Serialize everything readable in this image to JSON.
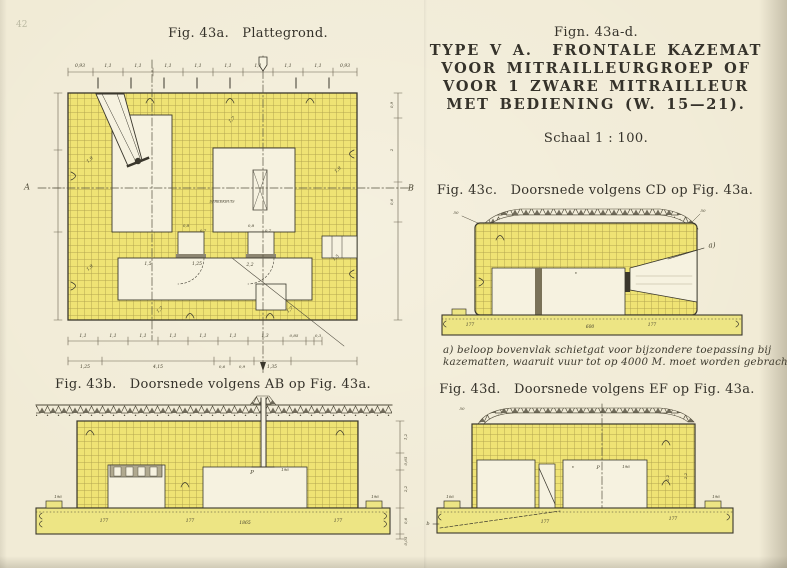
{
  "page": {
    "ghost_page_number": "42",
    "captions": {
      "fig43a": "Fig. 43a.   Plattegrond.",
      "fig43b": "Fig. 43b.   Doorsnede volgens AB op Fig. 43a.",
      "fig43c": "Fig. 43c.   Doorsnede volgens CD op Fig. 43a.",
      "fig43d": "Fig. 43d.   Doorsnede volgens EF op Fig. 43a."
    },
    "title_block": {
      "fign": "Fign. 43a-d.",
      "line1": "TYPE V A.  FRONTALE KAZEMAT",
      "line2": "VOOR MITRAILLEURGROEP OF",
      "line3": "VOOR 1 ZWARE MITRAILLEUR",
      "line4": "MET BEDIENING (W. 15—21).",
      "scale": "Schaal 1 : 100."
    },
    "note_a": {
      "line1": "a) beloop bovenvlak schietgat voor bijzondere toepassing bij",
      "line2": "kazematten, waaruit vuur tot op 4000 M. moet worden gebracht."
    }
  },
  "colors": {
    "paper": "#f1ebd6",
    "wall": "#efe374",
    "slab": "#ede584",
    "room": "#f6f2e0",
    "ink": "#35322a",
    "dim_ink": "#6a6350"
  },
  "drawing_labels": [
    {
      "t": "0,93",
      "x": 80,
      "y": 66,
      "s": 4.5
    },
    {
      "t": "1,1",
      "x": 108,
      "y": 66,
      "s": 4.5
    },
    {
      "t": "1,1",
      "x": 138,
      "y": 66,
      "s": 4.5
    },
    {
      "t": "1,1",
      "x": 168,
      "y": 66,
      "s": 4.5
    },
    {
      "t": "1,1",
      "x": 198,
      "y": 66,
      "s": 4.5
    },
    {
      "t": "1,1",
      "x": 228,
      "y": 66,
      "s": 4.5
    },
    {
      "t": "1,1",
      "x": 258,
      "y": 66,
      "s": 4.5
    },
    {
      "t": "1,1",
      "x": 288,
      "y": 66,
      "s": 4.5
    },
    {
      "t": "1,1",
      "x": 318,
      "y": 66,
      "s": 4.5
    },
    {
      "t": "0,93",
      "x": 345,
      "y": 66,
      "s": 4.5
    },
    {
      "t": "1,1",
      "x": 83,
      "y": 336,
      "s": 4.5
    },
    {
      "t": "1,1",
      "x": 113,
      "y": 336,
      "s": 4.5
    },
    {
      "t": "1,1",
      "x": 143,
      "y": 336,
      "s": 4.5
    },
    {
      "t": "1,1",
      "x": 173,
      "y": 336,
      "s": 4.5
    },
    {
      "t": "1,1",
      "x": 203,
      "y": 336,
      "s": 4.5
    },
    {
      "t": "1,1",
      "x": 233,
      "y": 336,
      "s": 4.5
    },
    {
      "t": "1,3",
      "x": 265,
      "y": 336,
      "s": 4.5
    },
    {
      "t": "0,85",
      "x": 294,
      "y": 336,
      "s": 4
    },
    {
      "t": "0,3",
      "x": 318,
      "y": 336,
      "s": 4
    },
    {
      "t": "1,25",
      "x": 85,
      "y": 367,
      "s": 4.5
    },
    {
      "t": "4,15",
      "x": 158,
      "y": 367,
      "s": 4.5
    },
    {
      "t": "0,6",
      "x": 222,
      "y": 367,
      "s": 4
    },
    {
      "t": "0,9",
      "x": 242,
      "y": 367,
      "s": 4
    },
    {
      "t": "1,35",
      "x": 272,
      "y": 367,
      "s": 4.5
    },
    {
      "t": "A",
      "x": 27,
      "y": 188,
      "s": 8
    },
    {
      "t": "B",
      "x": 411,
      "y": 189,
      "s": 8
    },
    {
      "t": "0,9",
      "x": 392,
      "y": 105,
      "s": 4,
      "r": -90
    },
    {
      "t": "2",
      "x": 392,
      "y": 150,
      "s": 4,
      "r": -90
    },
    {
      "t": "0,6",
      "x": 392,
      "y": 202,
      "s": 4,
      "r": -90
    },
    {
      "t": "SPREEKBUIS",
      "x": 222,
      "y": 202,
      "s": 3.6
    },
    {
      "t": "0,8",
      "x": 186,
      "y": 226,
      "s": 4
    },
    {
      "t": "0,7",
      "x": 203,
      "y": 231,
      "s": 4
    },
    {
      "t": "0,8",
      "x": 251,
      "y": 226,
      "s": 4
    },
    {
      "t": "0,7",
      "x": 268,
      "y": 231,
      "s": 4
    },
    {
      "t": "1,5",
      "x": 148,
      "y": 264,
      "s": 4.5
    },
    {
      "t": "1,25",
      "x": 197,
      "y": 264,
      "s": 4.5
    },
    {
      "t": "2,2",
      "x": 250,
      "y": 265,
      "s": 4.5
    },
    {
      "t": "1,9",
      "x": 90,
      "y": 160,
      "s": 4.5,
      "r": -40
    },
    {
      "t": "1,7",
      "x": 232,
      "y": 120,
      "s": 4.5,
      "r": -40
    },
    {
      "t": "1,9",
      "x": 338,
      "y": 170,
      "s": 4.5,
      "r": -40
    },
    {
      "t": "1,9",
      "x": 90,
      "y": 268,
      "s": 4.5,
      "r": -40
    },
    {
      "t": "1,5",
      "x": 336,
      "y": 258,
      "s": 4.5,
      "r": -40
    },
    {
      "t": "1,7",
      "x": 160,
      "y": 310,
      "s": 4.5,
      "r": -40
    },
    {
      "t": "1,7",
      "x": 290,
      "y": 310,
      "s": 4.5,
      "r": -40
    },
    {
      "t": "50",
      "x": 456,
      "y": 213,
      "s": 4
    },
    {
      "t": "50",
      "x": 703,
      "y": 211,
      "s": 4
    },
    {
      "t": "a)",
      "x": 712,
      "y": 246,
      "s": 7
    },
    {
      "t": "v",
      "x": 576,
      "y": 273,
      "s": 4
    },
    {
      "t": "177",
      "x": 470,
      "y": 325,
      "s": 4.5
    },
    {
      "t": "600",
      "x": 590,
      "y": 327,
      "s": 4.5
    },
    {
      "t": "177",
      "x": 652,
      "y": 325,
      "s": 4.5
    },
    {
      "t": "P",
      "x": 252,
      "y": 473,
      "s": 5.5
    },
    {
      "t": "196",
      "x": 285,
      "y": 470,
      "s": 4
    },
    {
      "t": "196",
      "x": 58,
      "y": 497,
      "s": 4
    },
    {
      "t": "196",
      "x": 375,
      "y": 497,
      "s": 4
    },
    {
      "t": "177",
      "x": 104,
      "y": 521,
      "s": 4.5
    },
    {
      "t": "177",
      "x": 190,
      "y": 521,
      "s": 4.5
    },
    {
      "t": "1865",
      "x": 245,
      "y": 523,
      "s": 4.5
    },
    {
      "t": "177",
      "x": 338,
      "y": 521,
      "s": 4.5
    },
    {
      "t": "1,2",
      "x": 406,
      "y": 437,
      "s": 4,
      "r": -90
    },
    {
      "t": "0,65",
      "x": 406,
      "y": 461,
      "s": 4,
      "r": -90
    },
    {
      "t": "2,2",
      "x": 406,
      "y": 489,
      "s": 4,
      "r": -90
    },
    {
      "t": "0,6",
      "x": 406,
      "y": 521,
      "s": 4,
      "r": -90
    },
    {
      "t": "0,05",
      "x": 406,
      "y": 541,
      "s": 4,
      "r": -90
    },
    {
      "t": "50",
      "x": 462,
      "y": 409,
      "s": 4
    },
    {
      "t": "v",
      "x": 573,
      "y": 467,
      "s": 4
    },
    {
      "t": "P",
      "x": 598,
      "y": 468,
      "s": 5
    },
    {
      "t": "196",
      "x": 626,
      "y": 467,
      "s": 4
    },
    {
      "t": "2,2",
      "x": 668,
      "y": 478,
      "s": 4,
      "r": -90
    },
    {
      "t": "2,2",
      "x": 686,
      "y": 476,
      "s": 4,
      "r": -90
    },
    {
      "t": "106",
      "x": 450,
      "y": 497,
      "s": 4
    },
    {
      "t": "196",
      "x": 716,
      "y": 497,
      "s": 4
    },
    {
      "t": "b",
      "x": 428,
      "y": 524,
      "s": 5
    },
    {
      "t": "177",
      "x": 545,
      "y": 522,
      "s": 4.5
    },
    {
      "t": "177",
      "x": 673,
      "y": 519,
      "s": 4.5
    }
  ]
}
